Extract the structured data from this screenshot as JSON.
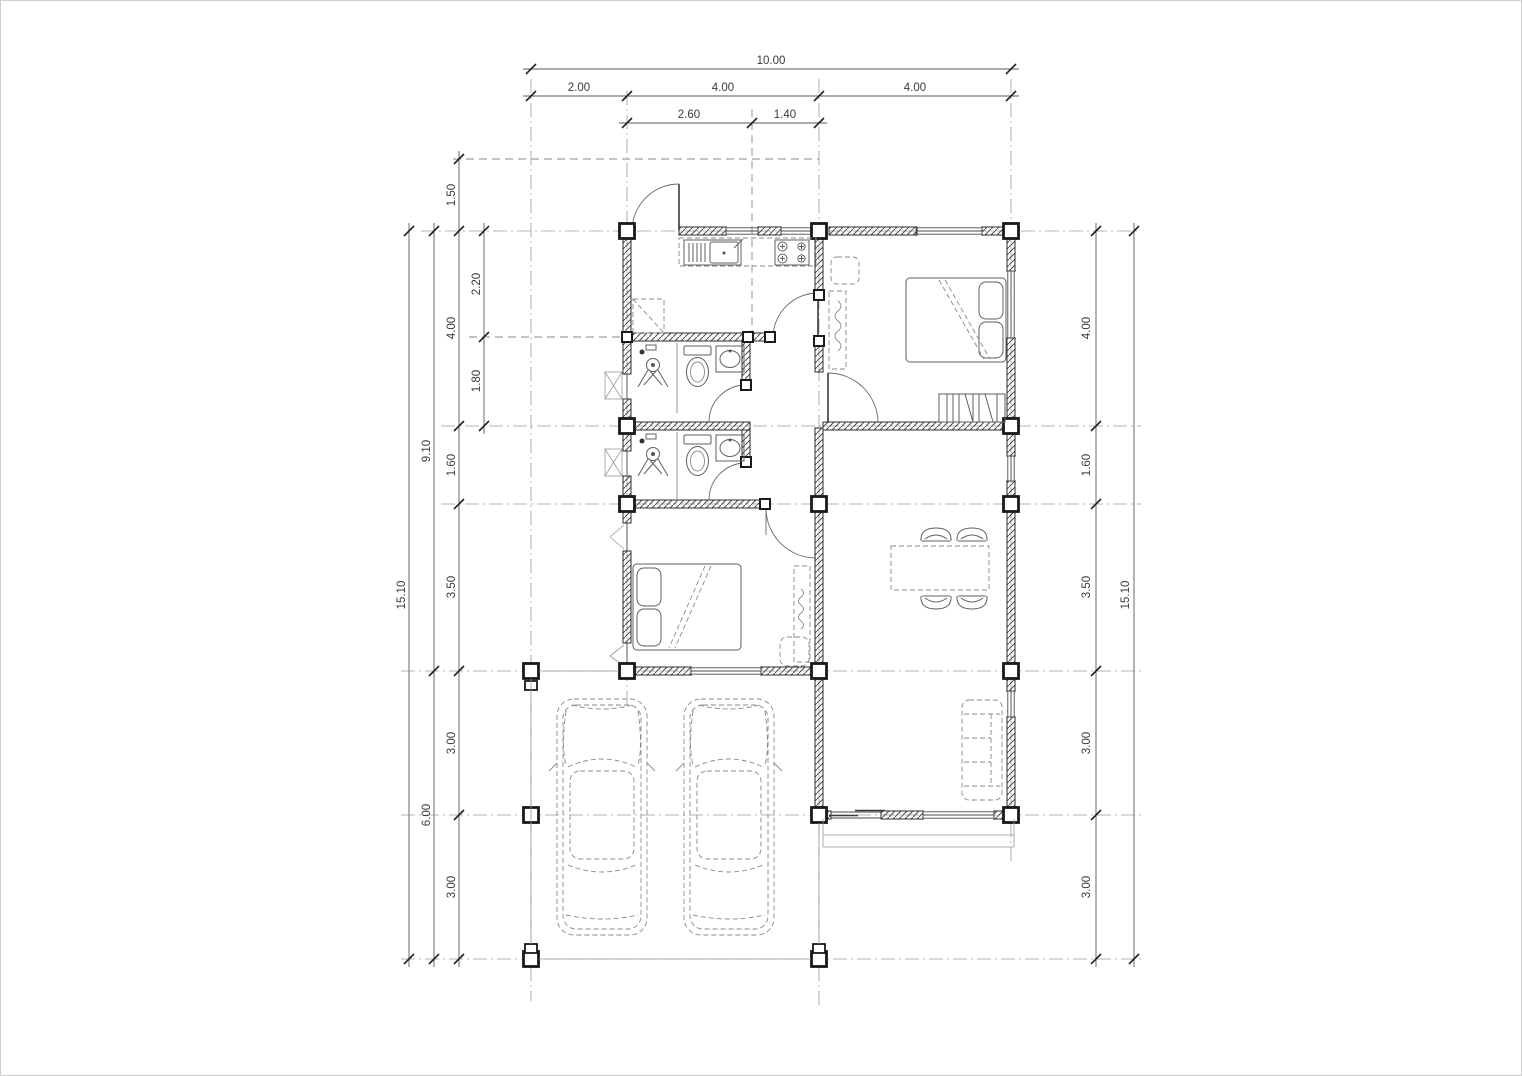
{
  "drawing": {
    "type": "architectural floor plan",
    "units": "meters",
    "view": "top-down plan with dimension chains"
  },
  "colors": {
    "background": "#ffffff",
    "wall_line": "#2e2e2e",
    "dimension_line": "#5a5a5a",
    "grid_line": "#9b9b9b",
    "text": "#3a3a3a",
    "furniture_line": "#6a6a6a"
  },
  "dimensions": {
    "top": {
      "overall": "10.00",
      "segments": [
        "2.00",
        "4.00",
        "4.00"
      ],
      "sub_segments": [
        "2.60",
        "1.40"
      ]
    },
    "left": {
      "overall": "15.10",
      "groups": [
        "9.10",
        "6.00"
      ],
      "segments": [
        "1.50",
        "4.00",
        "1.60",
        "3.50",
        "3.00",
        "3.00"
      ],
      "sub_segments": [
        "2.20",
        "1.80"
      ]
    },
    "right": {
      "segments": [
        "4.00",
        "1.60",
        "3.50",
        "3.00",
        "3.00"
      ],
      "overall": "15.10"
    }
  },
  "symbols": [
    "column",
    "hatched-wall",
    "window",
    "door-swing",
    "sliding-door",
    "kitchen-sink",
    "stove",
    "refrigerator",
    "shower",
    "toilet",
    "wash-basin",
    "double-bed",
    "pillows",
    "desk",
    "chair",
    "wardrobe",
    "dining-table",
    "dining-chair",
    "sofa",
    "car"
  ]
}
